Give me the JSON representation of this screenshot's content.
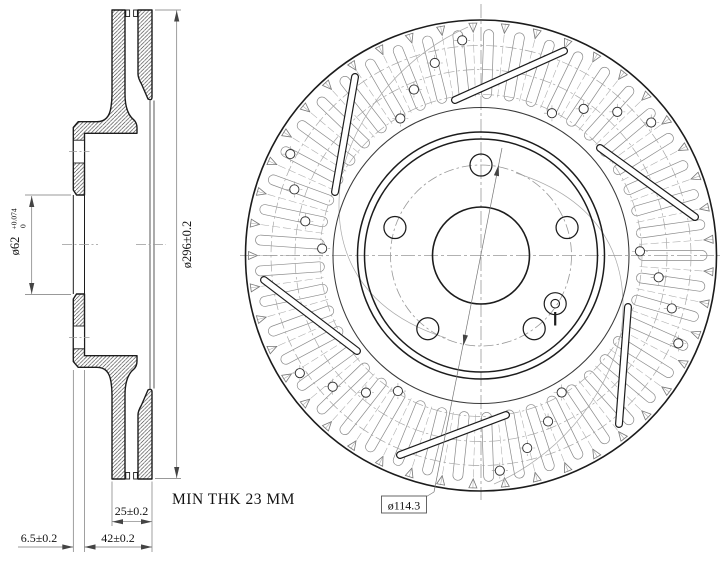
{
  "drawing": {
    "labels": {
      "outer_dia": "ø296±0.2",
      "bore_dia": "ø62",
      "bore_tol_up": "+0.074",
      "bore_tol_low": "0",
      "ring_thk": "25±0.2",
      "overall_h": "42±0.2",
      "flange_thk": "6.5±0.2",
      "min_thk": "MIN THK 23 MM",
      "bolt_circle": "ø114.3"
    },
    "colors": {
      "line": "#1c1c1c",
      "medium": "#3a3a3a",
      "thin": "#777777",
      "pattern": "#8a8a8a",
      "center": "#999999",
      "arrow": "#444444",
      "text": "#111111",
      "bg": "#ffffff"
    }
  }
}
